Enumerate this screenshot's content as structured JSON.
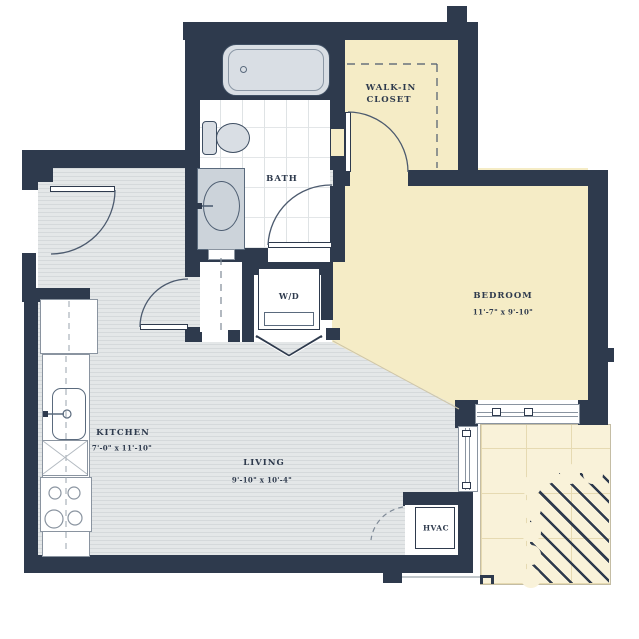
{
  "plan": {
    "rooms": {
      "closet": {
        "line1": "WALK-IN",
        "line2": "CLOSET"
      },
      "bath": {
        "label": "BATH"
      },
      "bedroom": {
        "label": "BEDROOM",
        "dims": "11'-7\" x 9'-10\""
      },
      "kitchen": {
        "label": "KITCHEN",
        "dims": "7'-0\" x 11'-10\""
      },
      "living": {
        "label": "LIVING",
        "dims": "9'-10\" x 10'-4\""
      },
      "laundry": {
        "label": "W/D"
      },
      "hvac": {
        "label": "HVAC"
      }
    },
    "colors": {
      "wall": "#2e3a4d",
      "bedroom_fill": "#f5ecc6",
      "balcony_fill": "#f9f2d9",
      "wood_floor": "#e4e7e8",
      "tile_floor": "#ffffff",
      "fixture_fill": "#d9dee4"
    }
  }
}
